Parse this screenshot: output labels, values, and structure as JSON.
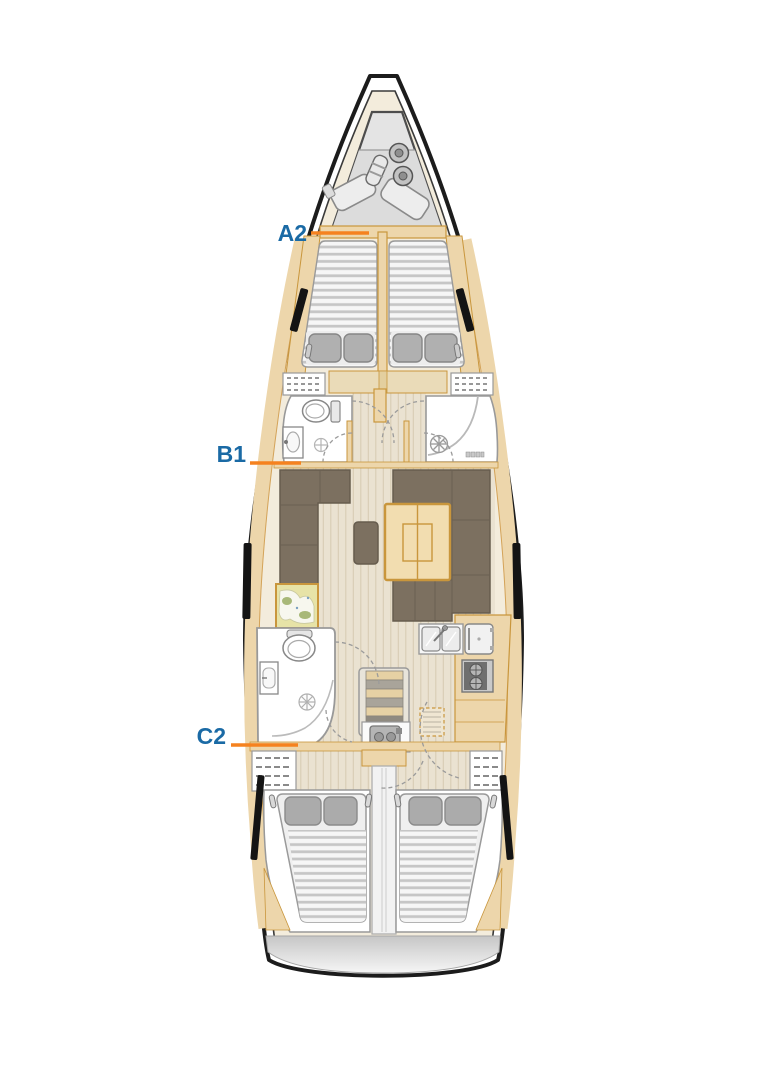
{
  "labels": {
    "a2": "A2",
    "b1": "B1",
    "c2": "C2"
  },
  "colors": {
    "label_text": "#1a6aa5",
    "leader_line": "#f5821f",
    "hull_outline": "#1c1c1c",
    "deck": "#ffffff",
    "interior_floor": "#f3ecdc",
    "wood": "#edd6ab",
    "wood_trim": "#c9963c",
    "upholstery": "#7c7060",
    "mattress": "#f6f6f6",
    "pillow": "#b0b0b0",
    "anchor_locker_gray": "#e4e4e4"
  },
  "fixtures": [
    "anchor-locker",
    "fenders",
    "sail-bags",
    "v-berth",
    "pillows",
    "reading-lamps",
    "toilet",
    "washbasin",
    "shower-drain",
    "door-swings",
    "saloon-settee",
    "saloon-table",
    "footstool",
    "chart-table",
    "galley-double-sink",
    "refrigerator",
    "stove",
    "companionway-steps",
    "engine",
    "hanging-lockers",
    "double-berth",
    "hull-windows",
    "swim-platform"
  ]
}
